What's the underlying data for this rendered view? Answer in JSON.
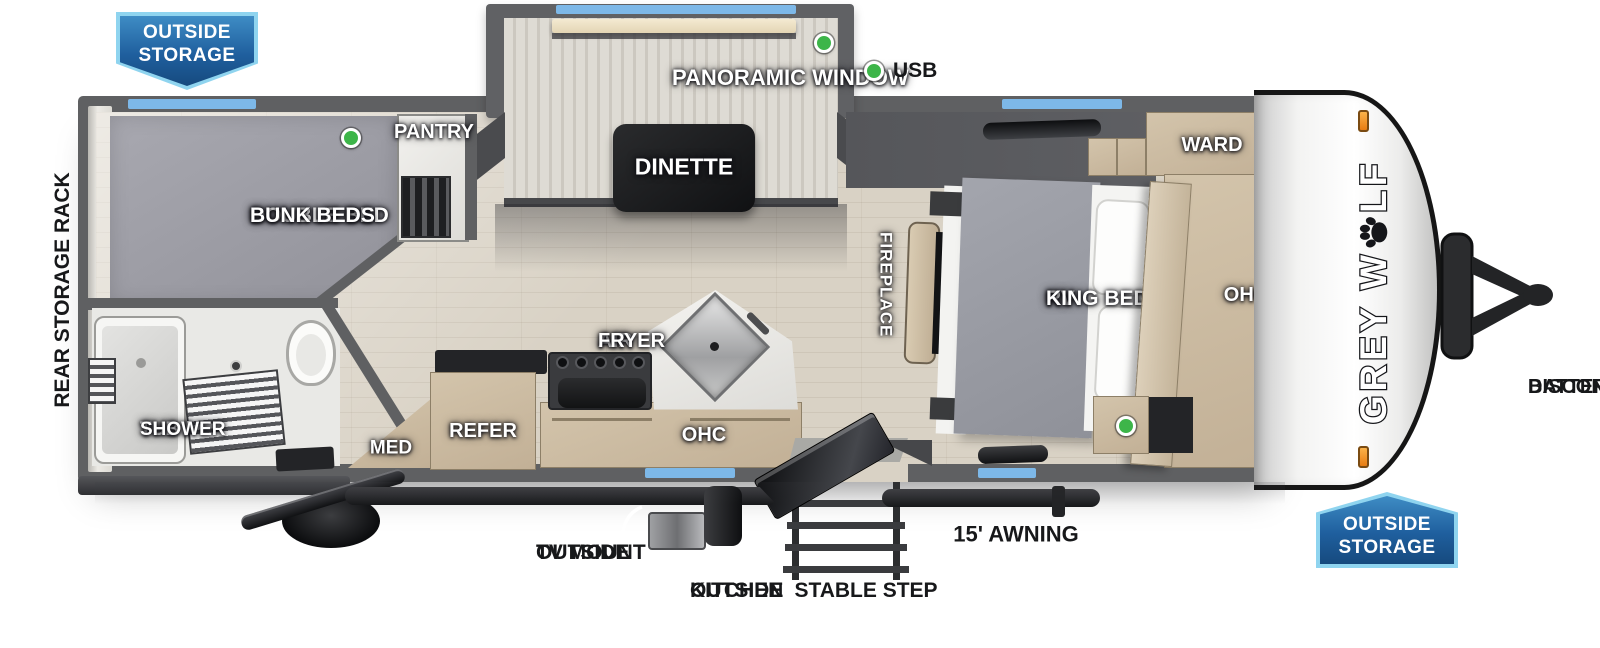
{
  "brand": {
    "name": "GREY WOLF",
    "prefix": "GREY W",
    "suffix": "LF",
    "paw_icon": "paw-print"
  },
  "badges": {
    "top_left": {
      "lines": [
        "OUTSIDE",
        "STORAGE"
      ]
    },
    "bottom_right": {
      "lines": [
        "OUTSIDE",
        "STORAGE"
      ]
    }
  },
  "exterior_labels": {
    "rear_storage_rack": "REAR STORAGE RACK",
    "usb": "USB",
    "outside_tv_mount": [
      "OUTSIDE",
      "TV MOUNT"
    ],
    "outside_kitchen": [
      "OUTSIDE",
      "KITCHEN"
    ],
    "stable_step": "STABLE STEP",
    "awning": "15' AWNING",
    "battery_disconnect": [
      "BATTERY",
      "DISCONNECT"
    ]
  },
  "interior_labels": {
    "bunk": [
      "DOUBLE BED",
      "BUNK BEDS"
    ],
    "pantry": "PANTRY",
    "panoramic_window": "PANORAMIC WINDOW",
    "dinette": "DINETTE",
    "fireplace": "FIREPLACE",
    "king_bed": [
      "RV",
      "KING BED"
    ],
    "ward": "WARD",
    "ohc_bedroom": "OHC",
    "ohc_kitchen": "OHC",
    "air_fryer": [
      "AIR",
      "FRYER"
    ],
    "refer": "REFER",
    "med": "MED",
    "tub_shower": [
      "TUB /",
      "SHOWER"
    ]
  },
  "colors": {
    "window_blue": "#7db8e8",
    "led_green": "#3db549",
    "badge_blue": "#1f5f9e",
    "badge_border": "#8fd4ef",
    "marker_orange": "#f6921e",
    "wall_gray": "#5f6062",
    "floor_wood": "#d9d2c5"
  }
}
